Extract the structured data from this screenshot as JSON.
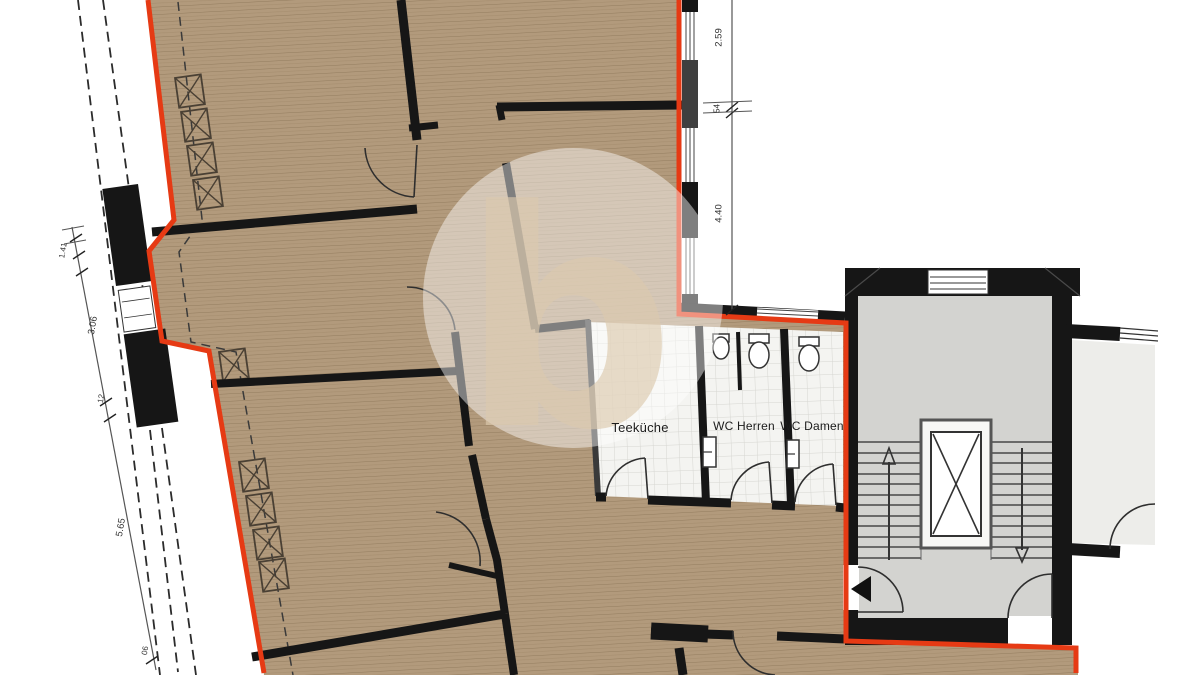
{
  "plan": {
    "rooms": {
      "kitchen_label": "Teeküche",
      "wc_men_label": "WC Herren",
      "wc_women_label": "WC Damen"
    },
    "dimensions": {
      "left": [
        "1.41",
        "3.06",
        "12",
        "5.65",
        "06"
      ],
      "right": [
        "2.59",
        "54",
        "4.40"
      ]
    },
    "watermark_letter": "b",
    "colors": {
      "lease_boundary_red": "#e63a14",
      "wall_black": "#161616",
      "wood_floor": "#b29a7c",
      "tile_floor": "#f4f4f1",
      "stairwell_floor": "#d3d3d0",
      "side_room_floor": "#ededea"
    }
  }
}
